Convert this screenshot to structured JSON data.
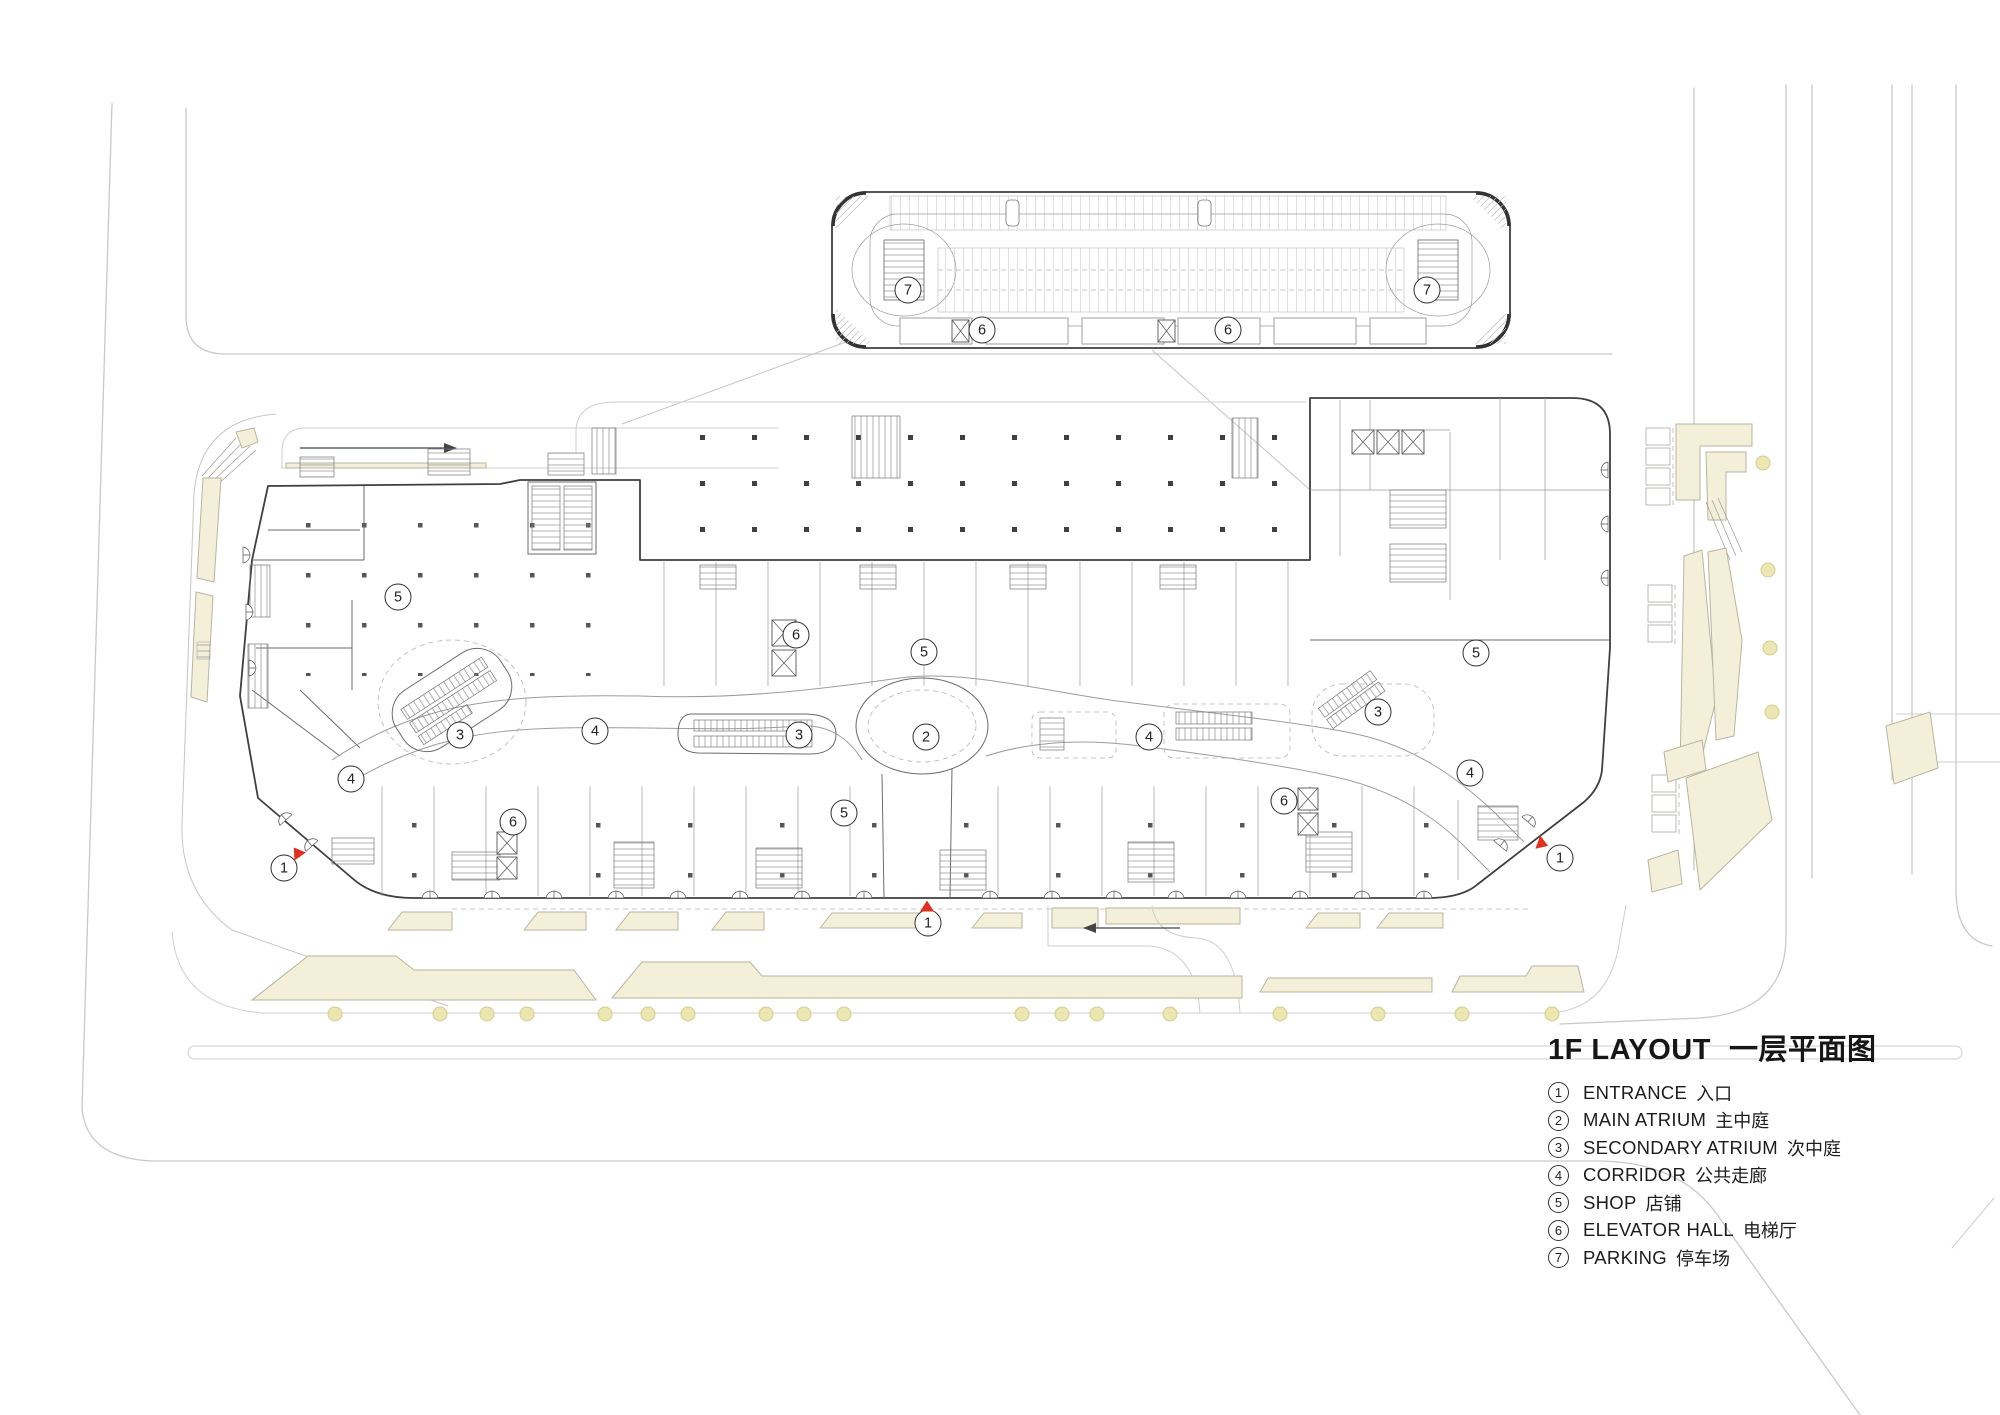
{
  "title": {
    "en": "1F LAYOUT",
    "zh": "一层平面图"
  },
  "legend": {
    "items": [
      {
        "num": "1",
        "label_en": "ENTRANCE",
        "label_zh": "入口"
      },
      {
        "num": "2",
        "label_en": "MAIN ATRIUM",
        "label_zh": "主中庭"
      },
      {
        "num": "3",
        "label_en": "SECONDARY ATRIUM",
        "label_zh": "次中庭"
      },
      {
        "num": "4",
        "label_en": "CORRIDOR",
        "label_zh": "公共走廊"
      },
      {
        "num": "5",
        "label_en": "SHOP",
        "label_zh": "店铺"
      },
      {
        "num": "6",
        "label_en": "ELEVATOR HALL",
        "label_zh": "电梯厅"
      },
      {
        "num": "7",
        "label_en": "PARKING",
        "label_zh": "停车场"
      }
    ]
  },
  "plan_markers": [
    {
      "n": "7",
      "x": 908,
      "y": 290
    },
    {
      "n": "7",
      "x": 1427,
      "y": 290
    },
    {
      "n": "6",
      "x": 982,
      "y": 330
    },
    {
      "n": "6",
      "x": 1228,
      "y": 330
    },
    {
      "n": "5",
      "x": 398,
      "y": 597
    },
    {
      "n": "6",
      "x": 796,
      "y": 635
    },
    {
      "n": "5",
      "x": 924,
      "y": 652
    },
    {
      "n": "5",
      "x": 1476,
      "y": 653
    },
    {
      "n": "3",
      "x": 460,
      "y": 735
    },
    {
      "n": "3",
      "x": 799,
      "y": 735
    },
    {
      "n": "2",
      "x": 926,
      "y": 737
    },
    {
      "n": "4",
      "x": 595,
      "y": 731
    },
    {
      "n": "4",
      "x": 1149,
      "y": 737
    },
    {
      "n": "3",
      "x": 1378,
      "y": 712
    },
    {
      "n": "4",
      "x": 351,
      "y": 779
    },
    {
      "n": "4",
      "x": 1470,
      "y": 773
    },
    {
      "n": "6",
      "x": 513,
      "y": 822
    },
    {
      "n": "6",
      "x": 1284,
      "y": 801
    },
    {
      "n": "5",
      "x": 844,
      "y": 813
    },
    {
      "n": "1",
      "x": 284,
      "y": 868
    },
    {
      "n": "1",
      "x": 928,
      "y": 923
    },
    {
      "n": "1",
      "x": 1560,
      "y": 858
    }
  ],
  "entrance_arrows": [
    {
      "x": 297,
      "y": 852,
      "rot": -35
    },
    {
      "x": 927,
      "y": 906,
      "rot": 0
    },
    {
      "x": 1543,
      "y": 844,
      "rot": 110
    }
  ],
  "trees": {
    "bottom_y": 1014,
    "bottom_xs": [
      335,
      440,
      487,
      527,
      605,
      648,
      688,
      766,
      804,
      844,
      1022,
      1062,
      1097,
      1170,
      1280,
      1378,
      1462,
      1552
    ],
    "right": [
      {
        "x": 1763,
        "y": 463
      },
      {
        "x": 1768,
        "y": 570
      },
      {
        "x": 1770,
        "y": 648
      },
      {
        "x": 1772,
        "y": 712
      }
    ]
  },
  "colors": {
    "road": "#c9c9c9",
    "wall_dark": "#3f3f3f",
    "land": "#f3efd9",
    "land_edge": "#b9b5a0",
    "tree": "#eae4a8",
    "tree_edge": "#cfc987",
    "entrance_red": "#e03020",
    "text": "#1f1f1f"
  }
}
